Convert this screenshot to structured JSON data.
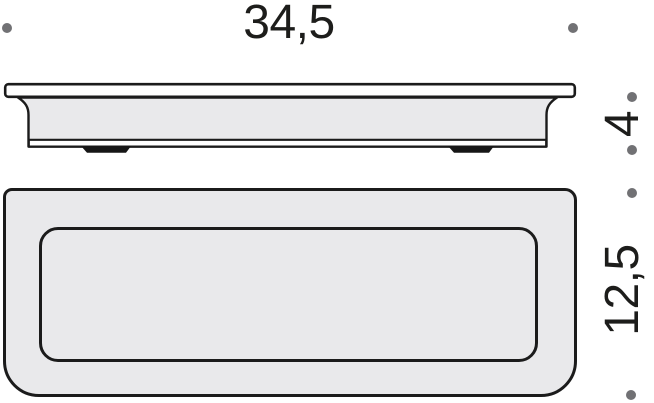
{
  "drawing": {
    "type": "product-dimension-diagram",
    "dimensions": {
      "width": {
        "label": "34,5"
      },
      "height": {
        "label": "4"
      },
      "depth": {
        "label": "12,5"
      }
    },
    "colors": {
      "outline": "#1b1b1b",
      "fill": "#e9e9eb",
      "marker": "#717174",
      "text": "#1d1d1b",
      "background": "#ffffff"
    }
  }
}
